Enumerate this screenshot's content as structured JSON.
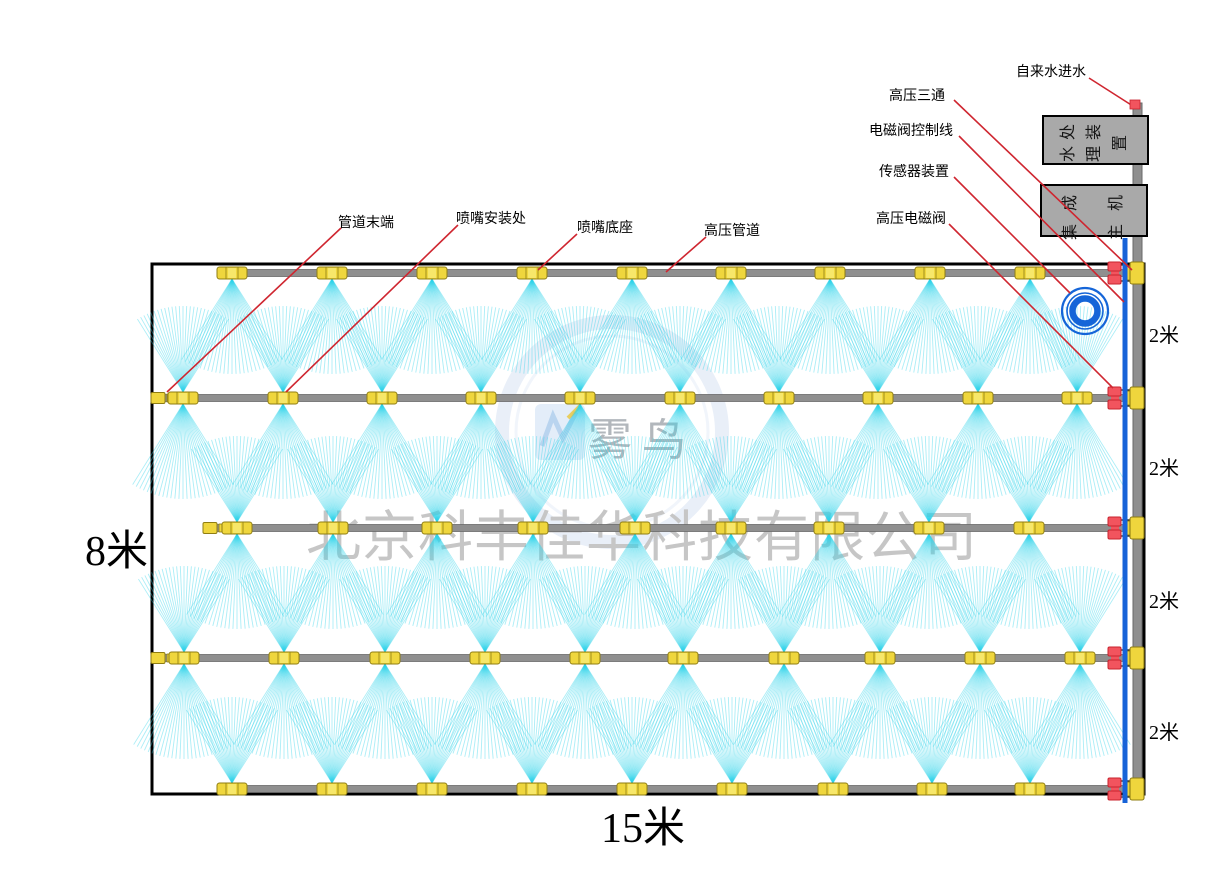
{
  "labels": {
    "callouts": [
      {
        "id": "pipe-end",
        "label": "管道末端"
      },
      {
        "id": "nozzle-install",
        "label": "喷嘴安装处"
      },
      {
        "id": "nozzle-base",
        "label": "喷嘴底座"
      },
      {
        "id": "hp-pipe",
        "label": "高压管道"
      },
      {
        "id": "hp-tee",
        "label": "高压三通"
      },
      {
        "id": "valve-control-line",
        "label": "电磁阀控制线"
      },
      {
        "id": "sensor-device",
        "label": "传感器装置"
      },
      {
        "id": "hp-solenoid-valve",
        "label": "高压电磁阀"
      },
      {
        "id": "tap-water-inlet",
        "label": "自来水进水"
      }
    ],
    "equipment": [
      {
        "id": "water-treatment",
        "label": "水处理装置",
        "display": "水处\n理装\n置"
      },
      {
        "id": "integrated-host",
        "label": "集成主机",
        "display": "集成\n主机"
      }
    ],
    "dimensions": {
      "height": "8米",
      "width": "15米",
      "row_spacing": [
        "2米",
        "2米",
        "2米",
        "2米"
      ]
    },
    "watermark": {
      "company": "北京科丰佳华科技有限公司",
      "brand": "雾鸟"
    }
  },
  "colors": {
    "pipe": "#8f8f8f",
    "pipe_edge": "#6a6a6a",
    "nozzle": "#efd63d",
    "nozzle_edge": "#8f7d12",
    "nozzle_hi": "#f7e76a",
    "spray": "#2ed3ea",
    "leader": "#cf2630",
    "valve": "#f2545e",
    "valve_edge": "#c8232e",
    "control_line": "#1763d8",
    "coil": "#1565d8",
    "border": "#000000"
  },
  "diagram": {
    "field_width_m": 15,
    "field_height_m": 8,
    "row_spacing_m": 2,
    "row_count": 5,
    "field": {
      "x": 152,
      "y": 264,
      "width": 992,
      "height": 530
    },
    "rows": [
      {
        "y": 273,
        "spray": "down",
        "pipe_start": 223,
        "cap_x": null,
        "nozzles": [
          232,
          332,
          432,
          532,
          632,
          731,
          830,
          930,
          1030
        ]
      },
      {
        "y": 398,
        "spray": "both",
        "pipe_start": 157,
        "cap_x": 151,
        "nozzles": [
          183,
          283,
          382,
          481,
          580,
          680,
          779,
          878,
          978,
          1077
        ]
      },
      {
        "y": 528,
        "spray": "both",
        "pipe_start": 210,
        "cap_x": 203,
        "nozzles": [
          237,
          333,
          437,
          533,
          635,
          731,
          829,
          929,
          1029
        ]
      },
      {
        "y": 658,
        "spray": "both",
        "pipe_start": 157,
        "cap_x": 151,
        "nozzles": [
          184,
          284,
          385,
          485,
          585,
          683,
          784,
          880,
          980,
          1080
        ]
      },
      {
        "y": 789,
        "spray": "up",
        "pipe_start": 225,
        "cap_x": null,
        "nozzles": [
          232,
          332,
          432,
          532,
          632,
          732,
          833,
          932,
          1030
        ]
      }
    ],
    "pipe_end_x": 1144,
    "main_pipe": {
      "x": 1133,
      "width": 9,
      "top": 103,
      "bottom": 800
    },
    "control_line": {
      "x": 1122.5,
      "width": 5,
      "top": 238,
      "bottom": 803
    },
    "valve_x": 1108,
    "tee_x": 1130,
    "coil": {
      "cx": 1085,
      "cy": 311
    },
    "fan": {
      "half_angle": 32,
      "down_len": 95,
      "up_len": 86,
      "rays": 27
    },
    "inlet_tip": {
      "x": 1130,
      "y": 100,
      "w": 10,
      "h": 9
    },
    "leaders": [
      {
        "id": "pipe-end",
        "x1": 341,
        "y1": 228,
        "x2": 167,
        "y2": 392
      },
      {
        "id": "nozzle-install",
        "x1": 458,
        "y1": 225,
        "x2": 286,
        "y2": 392
      },
      {
        "id": "nozzle-base",
        "x1": 577,
        "y1": 234,
        "x2": 538,
        "y2": 270
      },
      {
        "id": "hp-pipe",
        "x1": 706,
        "y1": 237,
        "x2": 666,
        "y2": 272
      },
      {
        "id": "hp-tee",
        "x1": 954,
        "y1": 100,
        "x2": 1132,
        "y2": 270
      },
      {
        "id": "valve-control-line",
        "x1": 959,
        "y1": 136,
        "x2": 1124,
        "y2": 302
      },
      {
        "id": "sensor-device",
        "x1": 954,
        "y1": 177,
        "x2": 1070,
        "y2": 293
      },
      {
        "id": "hp-solenoid-valve",
        "x1": 949,
        "y1": 224,
        "x2": 1113,
        "y2": 388
      },
      {
        "id": "tap-water-inlet",
        "x1": 1089,
        "y1": 78,
        "x2": 1136,
        "y2": 108
      }
    ]
  }
}
